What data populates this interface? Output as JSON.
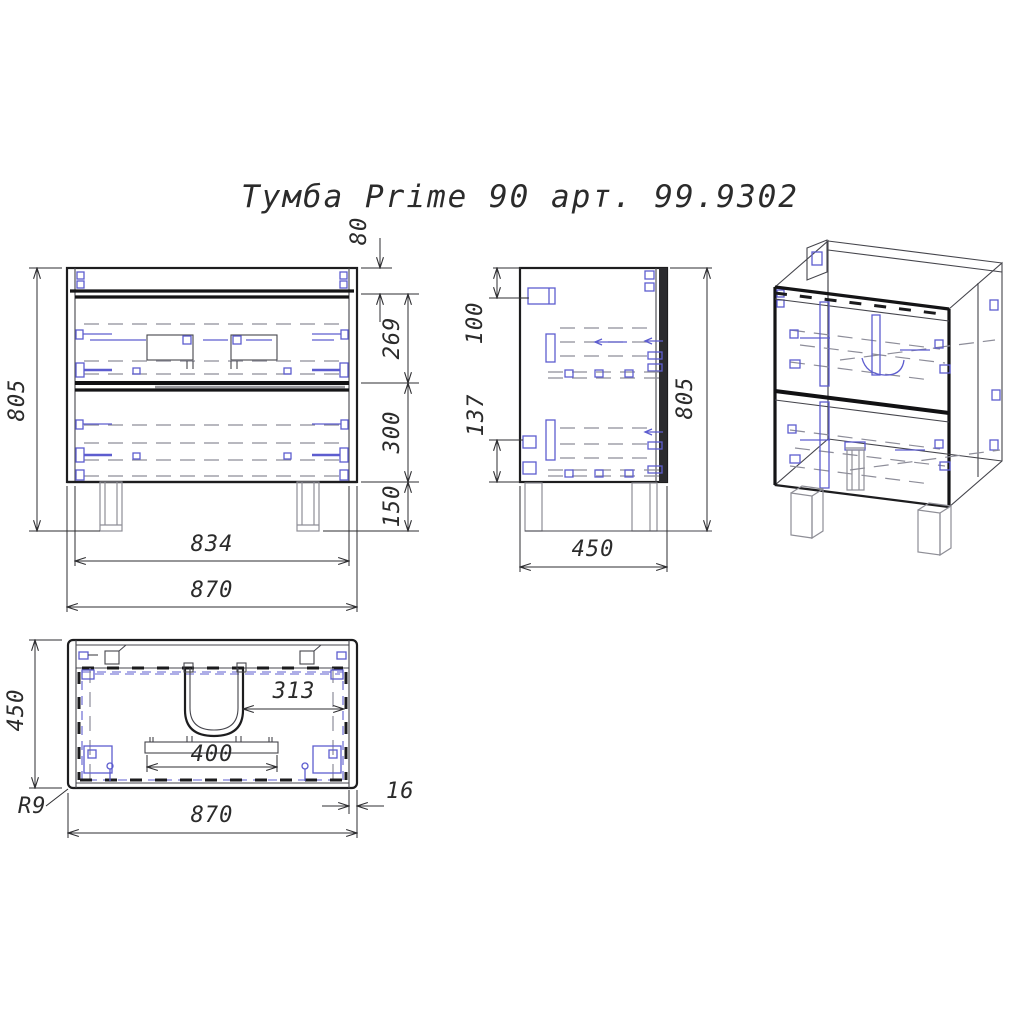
{
  "title": "Тумба Prime 90 арт. 99.9302",
  "front_view": {
    "height": "805",
    "top_rail_height": "80",
    "upper_drawer_height": "269",
    "lower_drawer_height": "300",
    "leg_height": "150",
    "inner_width": "834",
    "overall_width": "870"
  },
  "side_view": {
    "bracket_offset": "100",
    "lower_hardware_span": "137",
    "height": "805",
    "depth": "450"
  },
  "top_view": {
    "depth": "450",
    "cutout_to_side": "313",
    "plate_width": "400",
    "panel_thickness": "16",
    "corner_radius": "R9",
    "overall_width": "870"
  },
  "colors": {
    "background": "#ffffff",
    "outline": "#1d1d1f",
    "hidden_lines": "#8d8d99",
    "hardware_blue": "#5d5dcf",
    "dimension": "#2e2e31"
  }
}
